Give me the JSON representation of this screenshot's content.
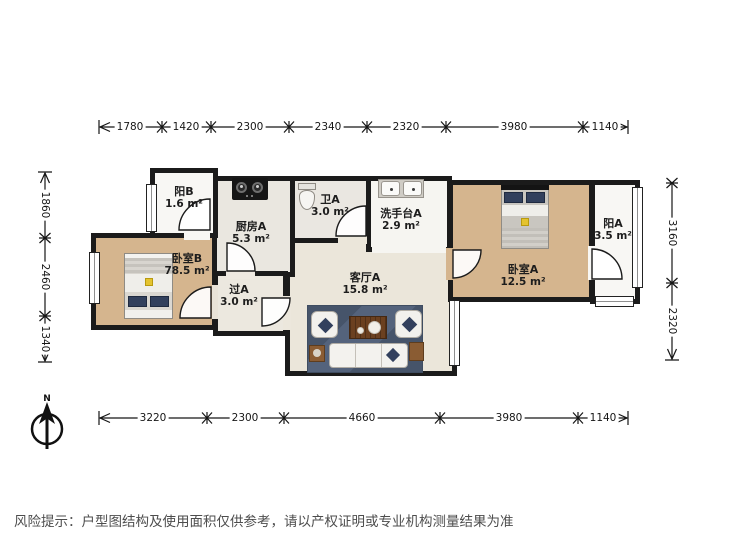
{
  "rooms": [
    {
      "name": "阳B",
      "area": "1.6 m²"
    },
    {
      "name": "厨房A",
      "area": "5.3 m²"
    },
    {
      "name": "卫A",
      "area": "3.0 m²"
    },
    {
      "name": "洗手台A",
      "area": "2.9 m²"
    },
    {
      "name": "卧室A",
      "area": "12.5 m²"
    },
    {
      "name": "阳A",
      "area": "3.5 m²"
    },
    {
      "name": "卧室B",
      "area": "78.5 m²"
    },
    {
      "name": "过A",
      "area": "3.0 m²"
    },
    {
      "name": "客厅A",
      "area": "15.8 m²"
    }
  ],
  "dimensions": {
    "top": [
      "1780",
      "1420",
      "2300",
      "2340",
      "2320",
      "3980",
      "1140"
    ],
    "bottom": [
      "3220",
      "2300",
      "4660",
      "3980",
      "1140"
    ],
    "left": [
      "1860",
      "2460",
      "1340"
    ],
    "right": [
      "3160",
      "2320"
    ]
  },
  "compass": {
    "north_label": "N"
  },
  "disclaimer": {
    "text": "风险提示：户型图结构及使用面积仅供参考，请以产权证明或专业机构测量结果为准"
  },
  "colors": {
    "wall": "#1b1b1b",
    "wood_floor": "#d5b58e",
    "living_floor": "#ebe6da",
    "kitchen_floor": "#eae7e0",
    "balcony_floor": "#f8f7f4",
    "rug": "#4e5d73",
    "pillow_accent": "#32405d",
    "decor_accent": "#e4c32f",
    "table_wood": "#6b4020"
  }
}
